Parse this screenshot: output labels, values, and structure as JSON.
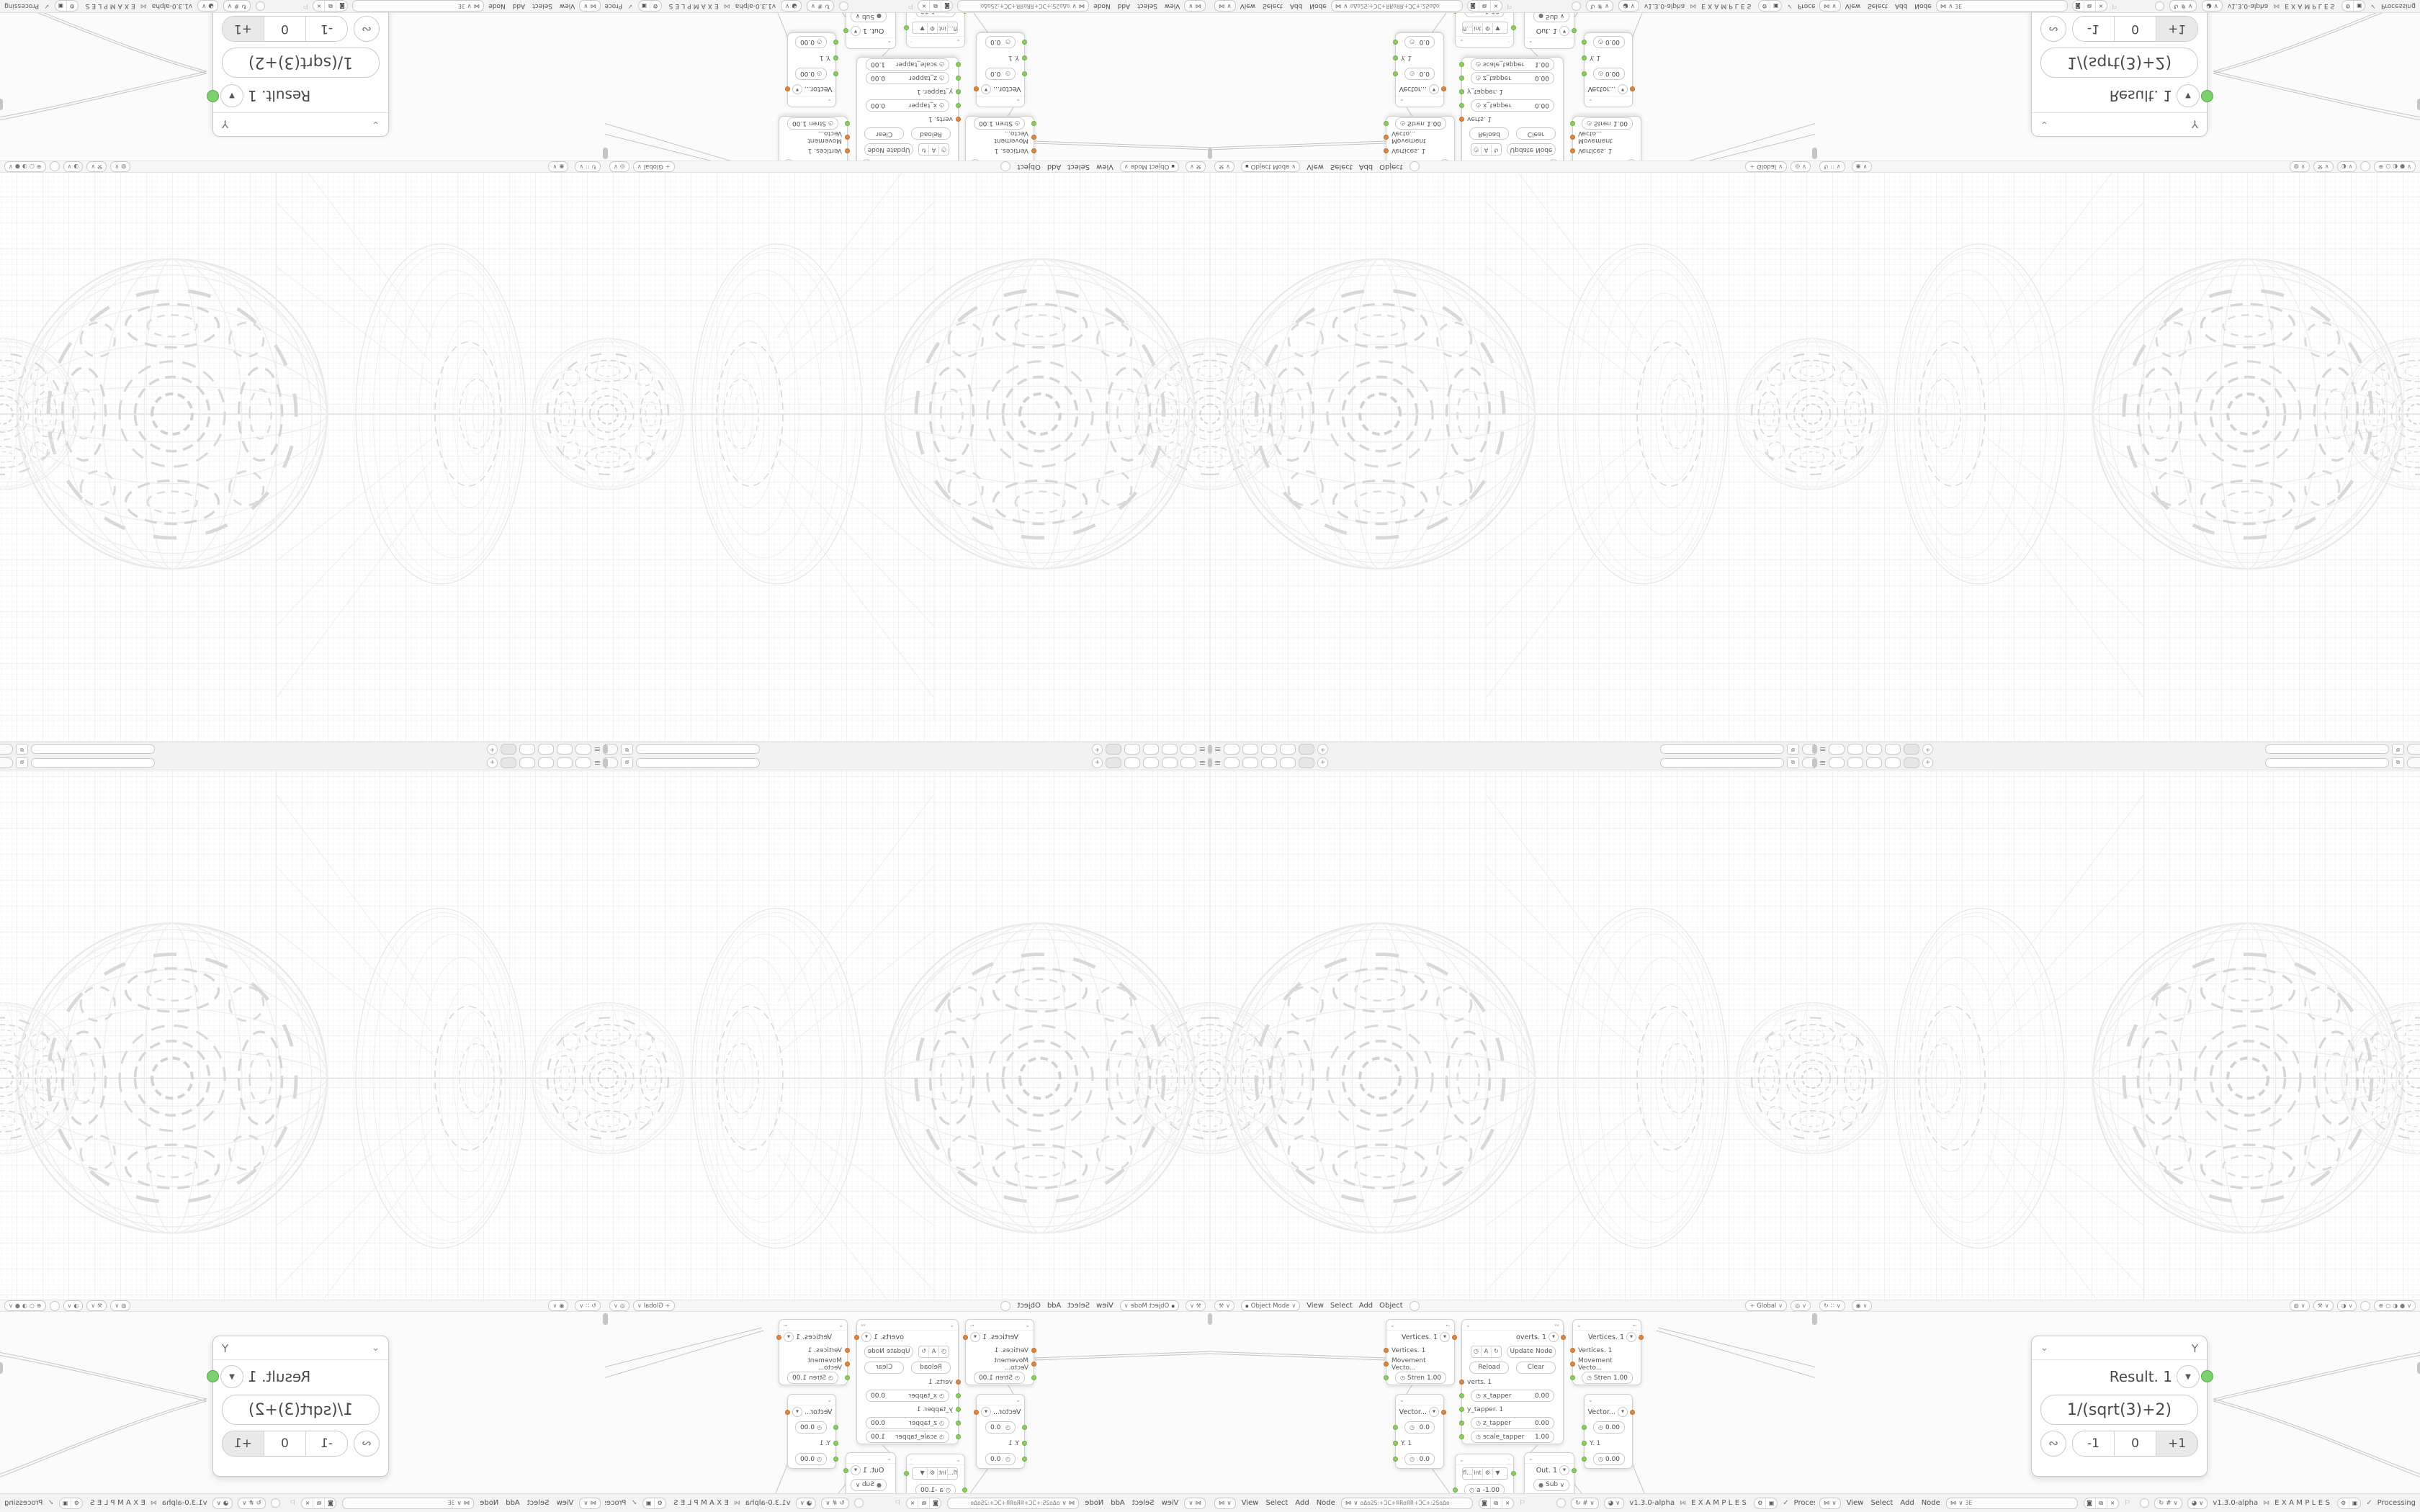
{
  "app": {
    "version": "v1.3.0-alpha",
    "examples_label": "EXAMPLES",
    "status": "Processing",
    "status_check": "✓",
    "dna_icon": "⋈"
  },
  "tabbar": {
    "menu_icon": "≡",
    "add_label": "+",
    "copy_icon": "⧉",
    "tab_count": 5
  },
  "viewport_header_main": {
    "editor_icon": "⚒",
    "chevron": "∨",
    "mode_icon": "▪",
    "mode_label": "Object Mode",
    "menu_view": "View",
    "menu_select": "Select",
    "menu_add": "Add",
    "menu_object": "Object",
    "orientation_icon": "+",
    "orientation_label": "Global",
    "snap_icon": "◎"
  },
  "viewport_header_alt": {
    "rotate_icon": "↻",
    "grid_icon": "∷",
    "prop_icon": "◉",
    "light_icon": "◍",
    "tool_icon": "⚒",
    "ball_icon": "◑",
    "shading_wire": "⊕",
    "shading_solid": "○",
    "shading_material": "◑",
    "shading_render": "●",
    "chevron": "∨"
  },
  "node_bar": {
    "editor_icon": "⋈",
    "chevron": "∨",
    "menu_view": "View",
    "menu_select": "Select",
    "menu_add": "Add",
    "menu_node": "Node",
    "input_main": "oΔo2S:+ƆC+ЯRoЯR+ƆC+:2SoΔo",
    "input_alt": "3E",
    "shield_icon": "◙",
    "copy_icon": "⧉",
    "close_icon": "×",
    "pin_icon": "⚐",
    "rotate_icon": "↻",
    "hash_icon": "#",
    "ball_icon": "◕",
    "gear_icon": "⚙",
    "term_icon": "▣"
  },
  "result_node": {
    "collapse_icon": "⌄",
    "tree_icon": "⅄",
    "title": "Result. 1",
    "dropdown_icon": "▼",
    "expression": "1/(sqrt(3)+2)",
    "link_icon": "∾",
    "btn_minus": "-1",
    "btn_zero": "0",
    "btn_plus": "+1",
    "active_button": "+1"
  },
  "cluster": {
    "vertices1": {
      "title": "Vertices. 1",
      "dropdown_icon": "▼",
      "collapse_icon": "⌄",
      "type_icon": "⌙",
      "in1": "Vertices. 1",
      "in2": "Movement Vecto...",
      "f1_icon": "◷",
      "f1_label": "Stren",
      "f1_value": "1.00"
    },
    "vertices2": {
      "title": "Vertices. 1",
      "dropdown_icon": "▼",
      "collapse_icon": "⌄",
      "type_icon": "⌙",
      "in1": "Vertices. 1",
      "in2": "Movement Vecto...",
      "f1_icon": "◷",
      "f1_label": "Stren",
      "f1_value": "1.00"
    },
    "update": {
      "title": "overts. 1",
      "dropdown_icon": "▼",
      "collapse_icon": "⌄",
      "type_icon": "∾",
      "icon1": "◷",
      "icon2": "A",
      "icon3": "↻",
      "update_btn": "Update Node",
      "reload_btn": "Reload",
      "clear_btn": "Clear",
      "in1": "verts. 1",
      "f1_icon": "◷",
      "f1_label": "x_tapper",
      "f1_value": "0.00",
      "in2": "y_tapper. 1",
      "f2_icon": "◷",
      "f2_label": "z_tapper",
      "f2_value": "0.00",
      "f3_icon": "◷",
      "f3_label": "scale_tapper",
      "f3_value": "1.00"
    },
    "vector1": {
      "title": "Vector...",
      "dropdown_icon": "▼",
      "collapse_icon": "⌄",
      "f1_icon": "◷",
      "f1_value": "0.0",
      "in1": "Y. 1",
      "f2_icon": "◷",
      "f2_value": "0.0"
    },
    "vector2": {
      "title": "Vector...",
      "dropdown_icon": "▼",
      "collapse_icon": "⌄",
      "f1_icon": "◷",
      "f1_value": "0.00",
      "in1": "Y. 1",
      "f2_icon": "◷",
      "f2_value": "0.00"
    },
    "convert": {
      "collapse_icon": "⌄",
      "dot_icon": "·",
      "seg1": "fl...",
      "seg2": "int",
      "seg3": "⚙",
      "seg4": "▼",
      "f1_icon": "◷",
      "f1_label": "a",
      "f1_value": "-1.00"
    },
    "out": {
      "title": "Out. 1",
      "dropdown_icon": "▼",
      "collapse_icon": "⌄",
      "op_icon": "●",
      "op_label": "Sub",
      "op_chevron": "∨",
      "f1_icon": "◷",
      "f1_value": "0.00",
      "in1": "y. 1"
    }
  },
  "colors": {
    "socket_orange": "#e0883f",
    "socket_green": "#8cd05c",
    "result_socket_green": "#7bd16b",
    "grid_minor": "#f1f1f1",
    "grid_major": "#e4e4e4",
    "wire": "#c4c4c4",
    "chrome_bg": "#f3f3f3",
    "active_segment": "#e9e9e9"
  }
}
